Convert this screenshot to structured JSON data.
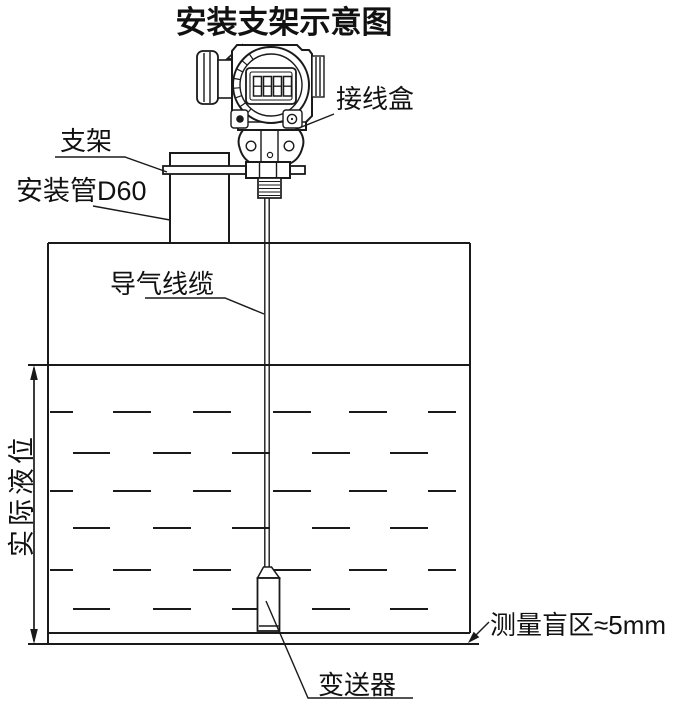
{
  "title": "安装支架示意图",
  "labels": {
    "junction_box": "接线盒",
    "bracket": "支架",
    "mounting_pipe": "安装管D60",
    "air_cable": "导气线缆",
    "actual_level": "实际液位",
    "blind_zone": "测量盲区≈5mm",
    "transmitter": "变送器"
  },
  "colors": {
    "line": "#1a1a1a",
    "background": "#ffffff"
  }
}
